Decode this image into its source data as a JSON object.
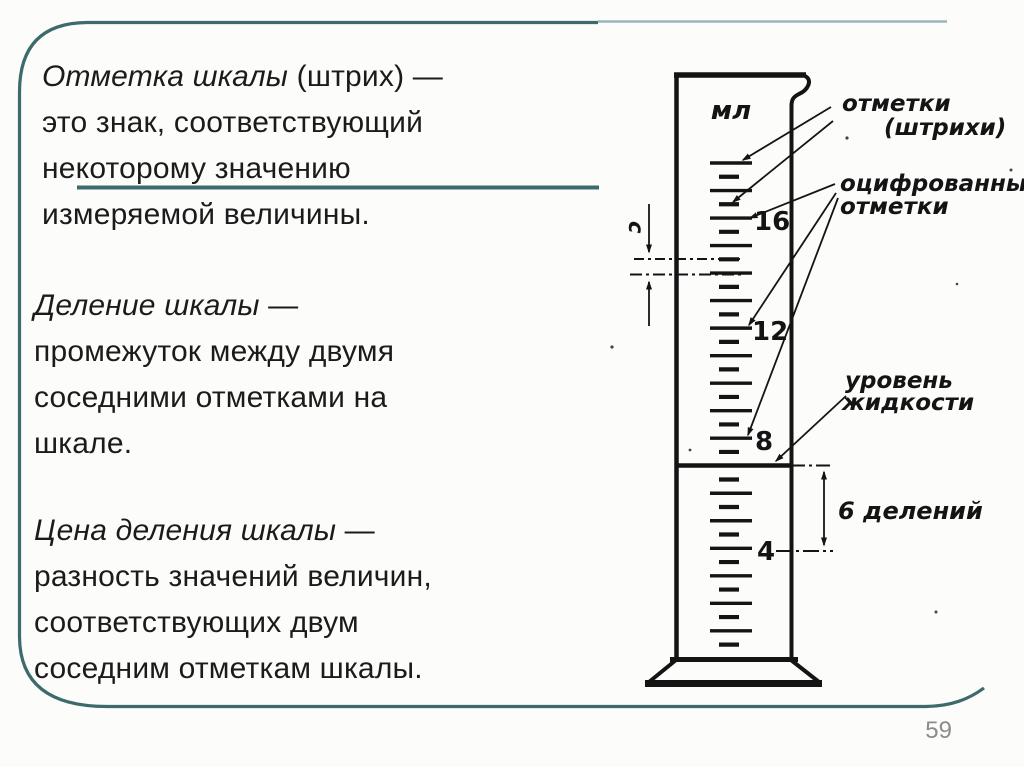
{
  "slide": {
    "page_number": "59",
    "colors": {
      "frame_dark": "#3d6b6c",
      "frame_light": "#97b8b8",
      "text": "#1b1b1b",
      "ink": "#141414",
      "page_number_gray": "#8c8c8c"
    },
    "definitions": {
      "p1": {
        "l1_term": "Отметка шкалы",
        "l1_rest": " (штрих) —",
        "l2": "это знак, соответствующий",
        "l3": "некоторому значению",
        "l4": "измеряемой величины."
      },
      "p2": {
        "l1_term": "Деление шкалы",
        "l1_rest": " —",
        "l2": "промежуток между двумя",
        "l3": "соседними отметками на",
        "l4": "шкале."
      },
      "p3": {
        "l1_term": "Цена деления шкалы",
        "l1_rest": " —",
        "l2": "разность значений величин,",
        "l3": "соответствующих двум",
        "l4": "соседним отметкам шкалы."
      }
    },
    "diagram": {
      "unit_label": "мл",
      "scale_numbers": [
        "16",
        "12",
        "8",
        "4"
      ],
      "labels": {
        "marks_line1": "отметки",
        "marks_line2": "(штрихи)",
        "numbered_line1": "оцифрованные",
        "numbered_line2": "отметки",
        "level_line1": "уровень",
        "level_line2": "жидкости",
        "divisions": "6 делений",
        "division_size": "с"
      },
      "ticks": {
        "x_long_start": 710,
        "x_long_end": 752,
        "x_short_start": 719,
        "x_short_end": 739,
        "top": 163,
        "step": 13.76,
        "count": 36,
        "liquid_index": 22
      }
    }
  }
}
